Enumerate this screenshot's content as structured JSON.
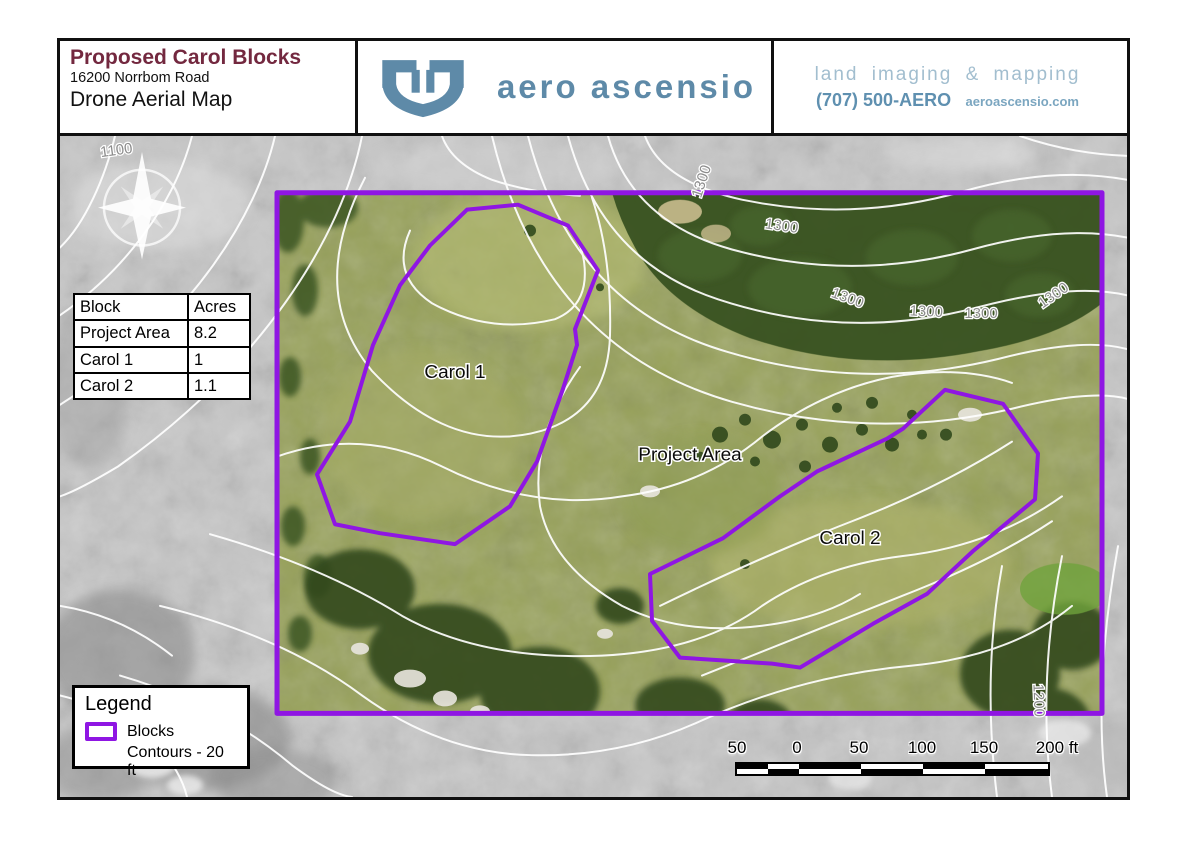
{
  "header": {
    "title": "Proposed Carol Blocks",
    "address": "16200 Norrbom Road",
    "subtitle": "Drone Aerial Map",
    "brand": "aero ascensio",
    "tagline": "land imaging & mapping",
    "phone": "(707) 500-AERO",
    "website": "aeroascensio.com"
  },
  "table": {
    "headers": [
      "Block",
      "Acres"
    ],
    "rows": [
      [
        "Project Area",
        "8.2"
      ],
      [
        "Carol 1",
        "1"
      ],
      [
        "Carol 2",
        "1.1"
      ]
    ]
  },
  "legend": {
    "title": "Legend",
    "blocks_label": "Blocks",
    "contours_label": "Contours - 20 ft"
  },
  "map": {
    "labels": {
      "carol1": "Carol 1",
      "project_area": "Project Area",
      "carol2": "Carol 2"
    },
    "contour_labels": [
      "1100",
      "1300",
      "1300",
      "1300",
      "1300",
      "1300",
      "1300",
      "1200"
    ],
    "contour_interval_ft": 20
  },
  "scalebar": {
    "labels": [
      "50",
      "0",
      "50",
      "100",
      "150",
      "200 ft"
    ]
  },
  "colors": {
    "boundary_purple": "#8f16e3",
    "title_maroon": "#73283f",
    "brand_blue": "#5e8aa8",
    "contour_white": "#ffffff"
  }
}
